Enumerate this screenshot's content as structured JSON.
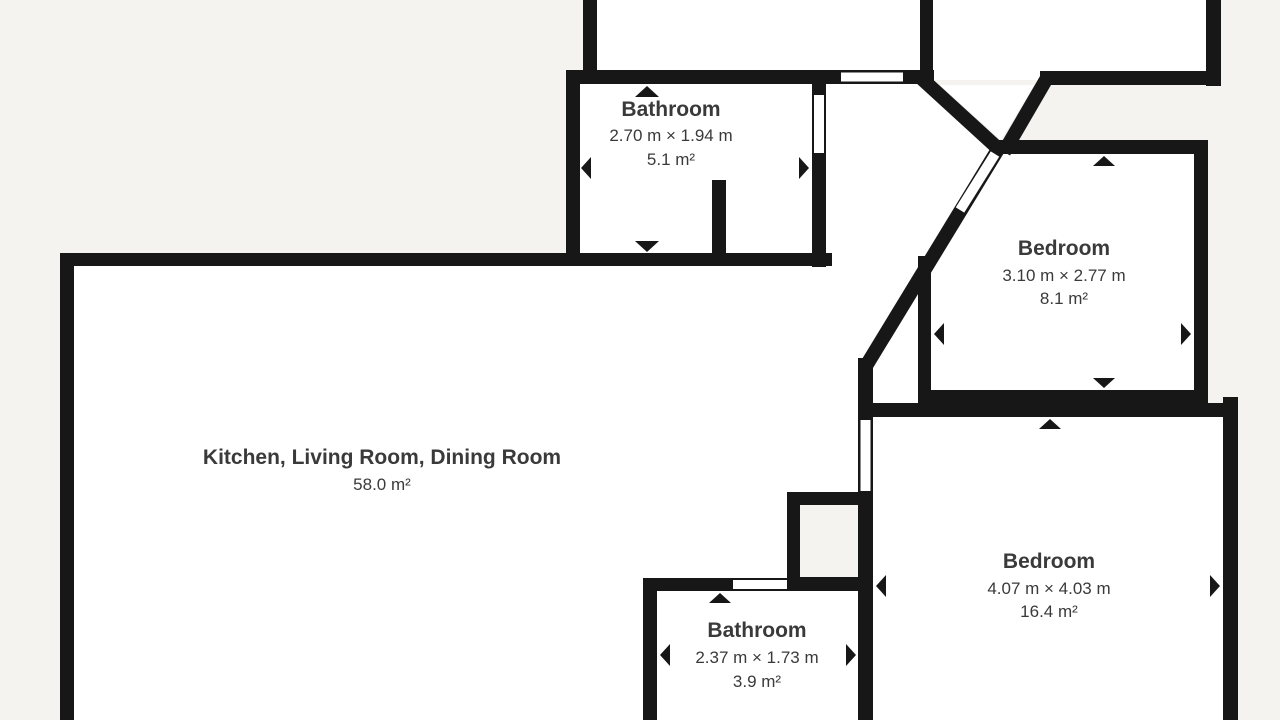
{
  "plan": {
    "type": "floor-plan",
    "colors": {
      "background": "#f4f3f0",
      "room_fill": "#ffffff",
      "wall": "#171717",
      "text": "#3a3a3a"
    },
    "rooms": [
      {
        "name": "Bathroom",
        "dimensions": "2.70 m × 1.94 m",
        "area": "5.1 m²"
      },
      {
        "name": "Bedroom",
        "dimensions": "3.10 m × 2.77 m",
        "area": "8.1 m²"
      },
      {
        "name": "Kitchen, Living Room, Dining Room",
        "area": "58.0 m²"
      },
      {
        "name": "Bedroom",
        "dimensions": "4.07 m × 4.03 m",
        "area": "16.4 m²"
      },
      {
        "name": "Bathroom",
        "dimensions": "2.37 m × 1.73 m",
        "area": "3.9 m²"
      }
    ]
  }
}
